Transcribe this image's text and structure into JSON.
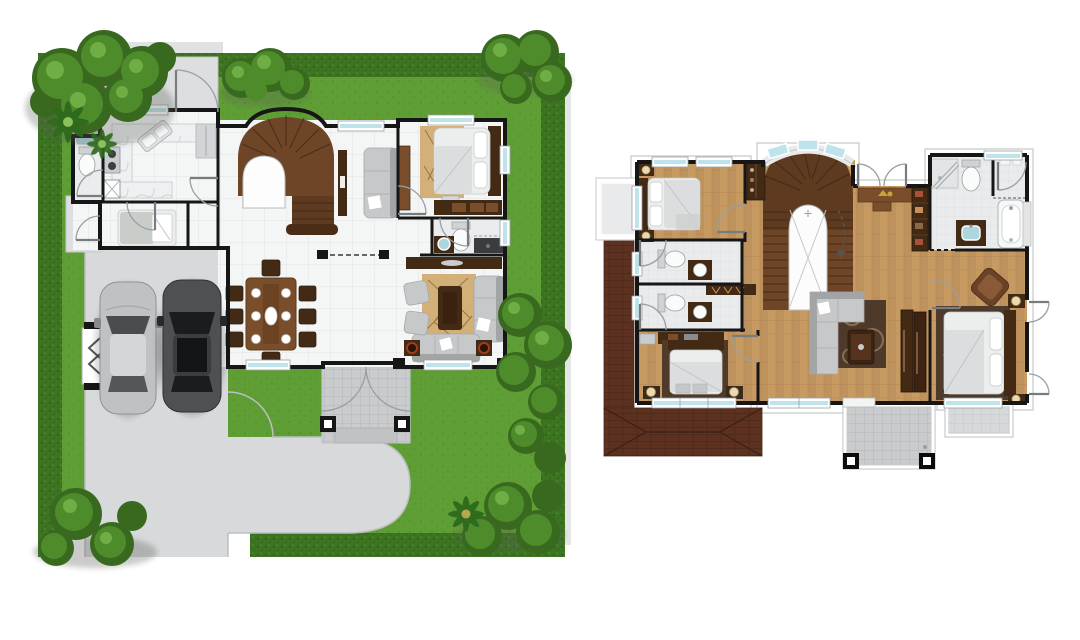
{
  "meta": {
    "type": "architectural-floor-plan-illustration",
    "views": [
      "ground-floor-site-plan",
      "second-floor-plan"
    ],
    "text_labels": []
  },
  "palette": {
    "grass": "#5f9e35",
    "grass_dark": "#4a8527",
    "hedge": "#3c7421",
    "hedge_dark": "#2c5a15",
    "hedge_light": "#5d9c35",
    "tree": "#4e8c2b",
    "tree_light": "#6fae45",
    "tree_dark": "#38691f",
    "shadow": "#5d6158",
    "driveway": "#d7d9da",
    "driveway_edge": "#bcbfc1",
    "concrete": "#dcdedf",
    "tile_floor": "#f4f5f5",
    "tile_line": "#e2e4e6",
    "wall": "#161616",
    "wood_floor": "#c79a62",
    "wood_floor_line": "#b2834e",
    "stair_wood": "#6e4526",
    "stair_wood_dark": "#4b2c16",
    "dark_wood": "#432a15",
    "mid_wood": "#7a4e2a",
    "roof": "#5c3120",
    "roof_line": "#47251a",
    "sofa_gray": "#c6c8c9",
    "sofa_gray_dark": "#a2a4a6",
    "fixture_white": "#fafbfb",
    "rug_tan": "#d3b078",
    "rug_tan_line": "#8a6534",
    "rug_dark": "#4e3a2a",
    "window_glass": "#bfe3ea",
    "sink_blue": "#aed6de",
    "gold": "#c9a23a",
    "porch_tile": "#c9cbcd",
    "porch_line": "#b4b7b9",
    "bath_tile": "#e9ebec",
    "lamp_cream": "#ead9b0"
  },
  "site_plan": {
    "label": "ground-floor-site-plan",
    "landscape": [
      "hedge-border",
      "lawn",
      "corner-trees",
      "fan-palms",
      "s-curve-driveway",
      "side-gate",
      "service-yard",
      "rear-gate"
    ],
    "vehicles": [
      "silver-car",
      "dark-gray-car"
    ],
    "rooms": [
      {
        "name": "bathroom-1",
        "furniture": [
          "toilet",
          "sink-counter"
        ]
      },
      {
        "name": "kitchen",
        "furniture": [
          "l-shaped-marble-counter",
          "diagonal-sink",
          "two-burner-stove",
          "washer",
          "lower-counter",
          "refrigerator"
        ]
      },
      {
        "name": "maids-room",
        "furniture": [
          "single-bed"
        ]
      },
      {
        "name": "side-patio",
        "furniture": []
      },
      {
        "name": "stair-foyer",
        "furniture": [
          "curved-staircase"
        ]
      },
      {
        "name": "family-nook",
        "furniture": [
          "sofa",
          "tv-console"
        ]
      },
      {
        "name": "bedroom-1",
        "furniture": [
          "double-bed",
          "area-rug",
          "dresser",
          "wardrobe",
          "bench"
        ]
      },
      {
        "name": "bathroom-2",
        "furniture": [
          "toilet",
          "vanity-sink",
          "shower"
        ]
      },
      {
        "name": "living-room",
        "furniture": [
          "console-table",
          "area-rug",
          "coffee-table",
          "sofa",
          "loveseat",
          "armchair-1",
          "armchair-2",
          "side-table-1",
          "side-table-2"
        ]
      },
      {
        "name": "dining-area",
        "furniture": [
          "dining-table",
          "eight-chairs",
          "place-settings"
        ]
      },
      {
        "name": "front-porch",
        "furniture": [
          "two-columns",
          "steps",
          "double-french-door"
        ]
      },
      {
        "name": "carport",
        "furniture": []
      }
    ]
  },
  "second_floor_plan": {
    "label": "second-floor-plan",
    "exterior": [
      "balcony-top-left",
      "center-balcony-with-columns",
      "right-balcony",
      "lower-roof-hip",
      "lower-roof-strip",
      "bow-window"
    ],
    "rooms": [
      {
        "name": "bedroom-2",
        "furniture": [
          "double-bed",
          "nightstand-lamps",
          "hall-wardrobe"
        ]
      },
      {
        "name": "bathroom-3",
        "furniture": [
          "toilet",
          "vanity-sink"
        ]
      },
      {
        "name": "bathroom-4",
        "furniture": [
          "toilet",
          "vanity-sink"
        ]
      },
      {
        "name": "bedroom-3",
        "furniture": [
          "double-bed",
          "dresser",
          "bench",
          "bedside-lamps"
        ]
      },
      {
        "name": "stair-hall",
        "furniture": [
          "u-shaped-staircase",
          "arched-stair-well",
          "console-table",
          "outward-double-door",
          "tall-cabinet",
          "slatted-bench"
        ]
      },
      {
        "name": "family-hall",
        "furniture": [
          "l-shaped-sofa",
          "area-rug",
          "coffee-table",
          "sliding-wardrobe"
        ]
      },
      {
        "name": "master-bathroom",
        "furniture": [
          "shower",
          "toilet",
          "bathtub",
          "vanity-sink",
          "towel-shelf"
        ]
      },
      {
        "name": "master-bedroom",
        "furniture": [
          "double-bed",
          "nightstand-lamps",
          "armchair",
          "area-rug"
        ]
      }
    ]
  }
}
